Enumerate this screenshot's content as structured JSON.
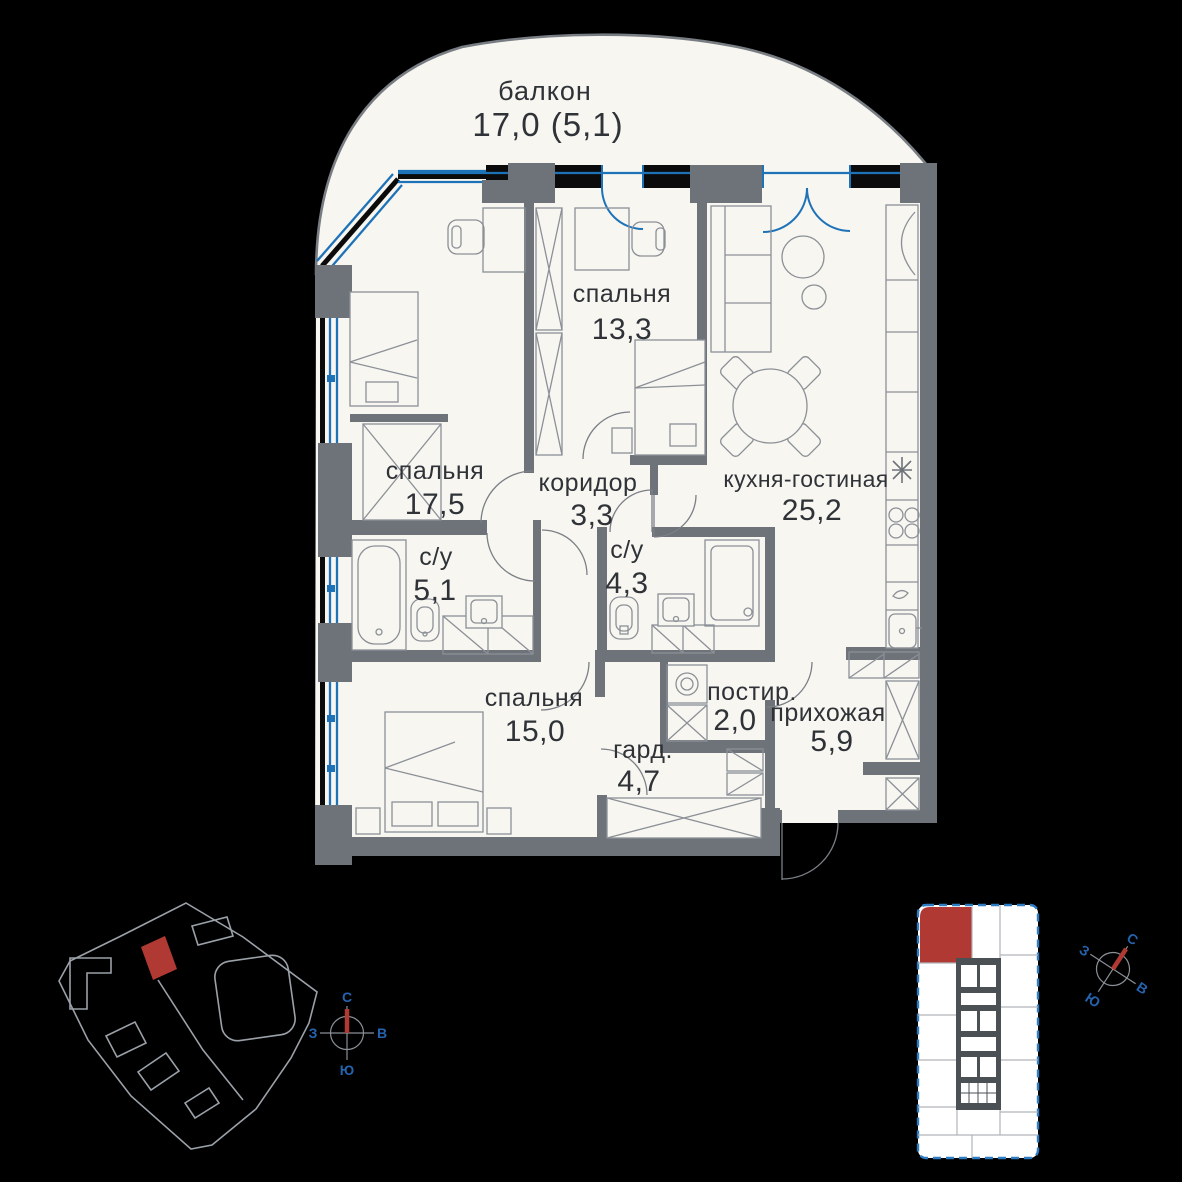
{
  "balcony": {
    "name": "балкон",
    "area": "17,0 (5,1)"
  },
  "rooms": [
    {
      "id": "bedroom-13",
      "name": "спальня",
      "area": "13,3"
    },
    {
      "id": "bedroom-17",
      "name": "спальня",
      "area": "17,5"
    },
    {
      "id": "corridor",
      "name": "коридор",
      "area": "3,3"
    },
    {
      "id": "kitchen-living",
      "name": "кухня-гостиная",
      "area": "25,2"
    },
    {
      "id": "bathroom-5",
      "name": "с/у",
      "area": "5,1"
    },
    {
      "id": "bathroom-4",
      "name": "с/у",
      "area": "4,3"
    },
    {
      "id": "bedroom-15",
      "name": "спальня",
      "area": "15,0"
    },
    {
      "id": "wardrobe",
      "name": "гард.",
      "area": "4,7"
    },
    {
      "id": "laundry",
      "name": "постир.",
      "area": "2,0"
    },
    {
      "id": "hallway",
      "name": "прихожая",
      "area": "5,9"
    }
  ],
  "compass": {
    "north": "С",
    "south": "Ю",
    "west": "З",
    "east": "В"
  },
  "colors": {
    "background": "#000000",
    "floor": "#f8f6f1",
    "wall": "#6e737a",
    "window_blue": "#1e73b8",
    "accent_red": "#b03a33",
    "compass_blue": "#2563ae"
  }
}
